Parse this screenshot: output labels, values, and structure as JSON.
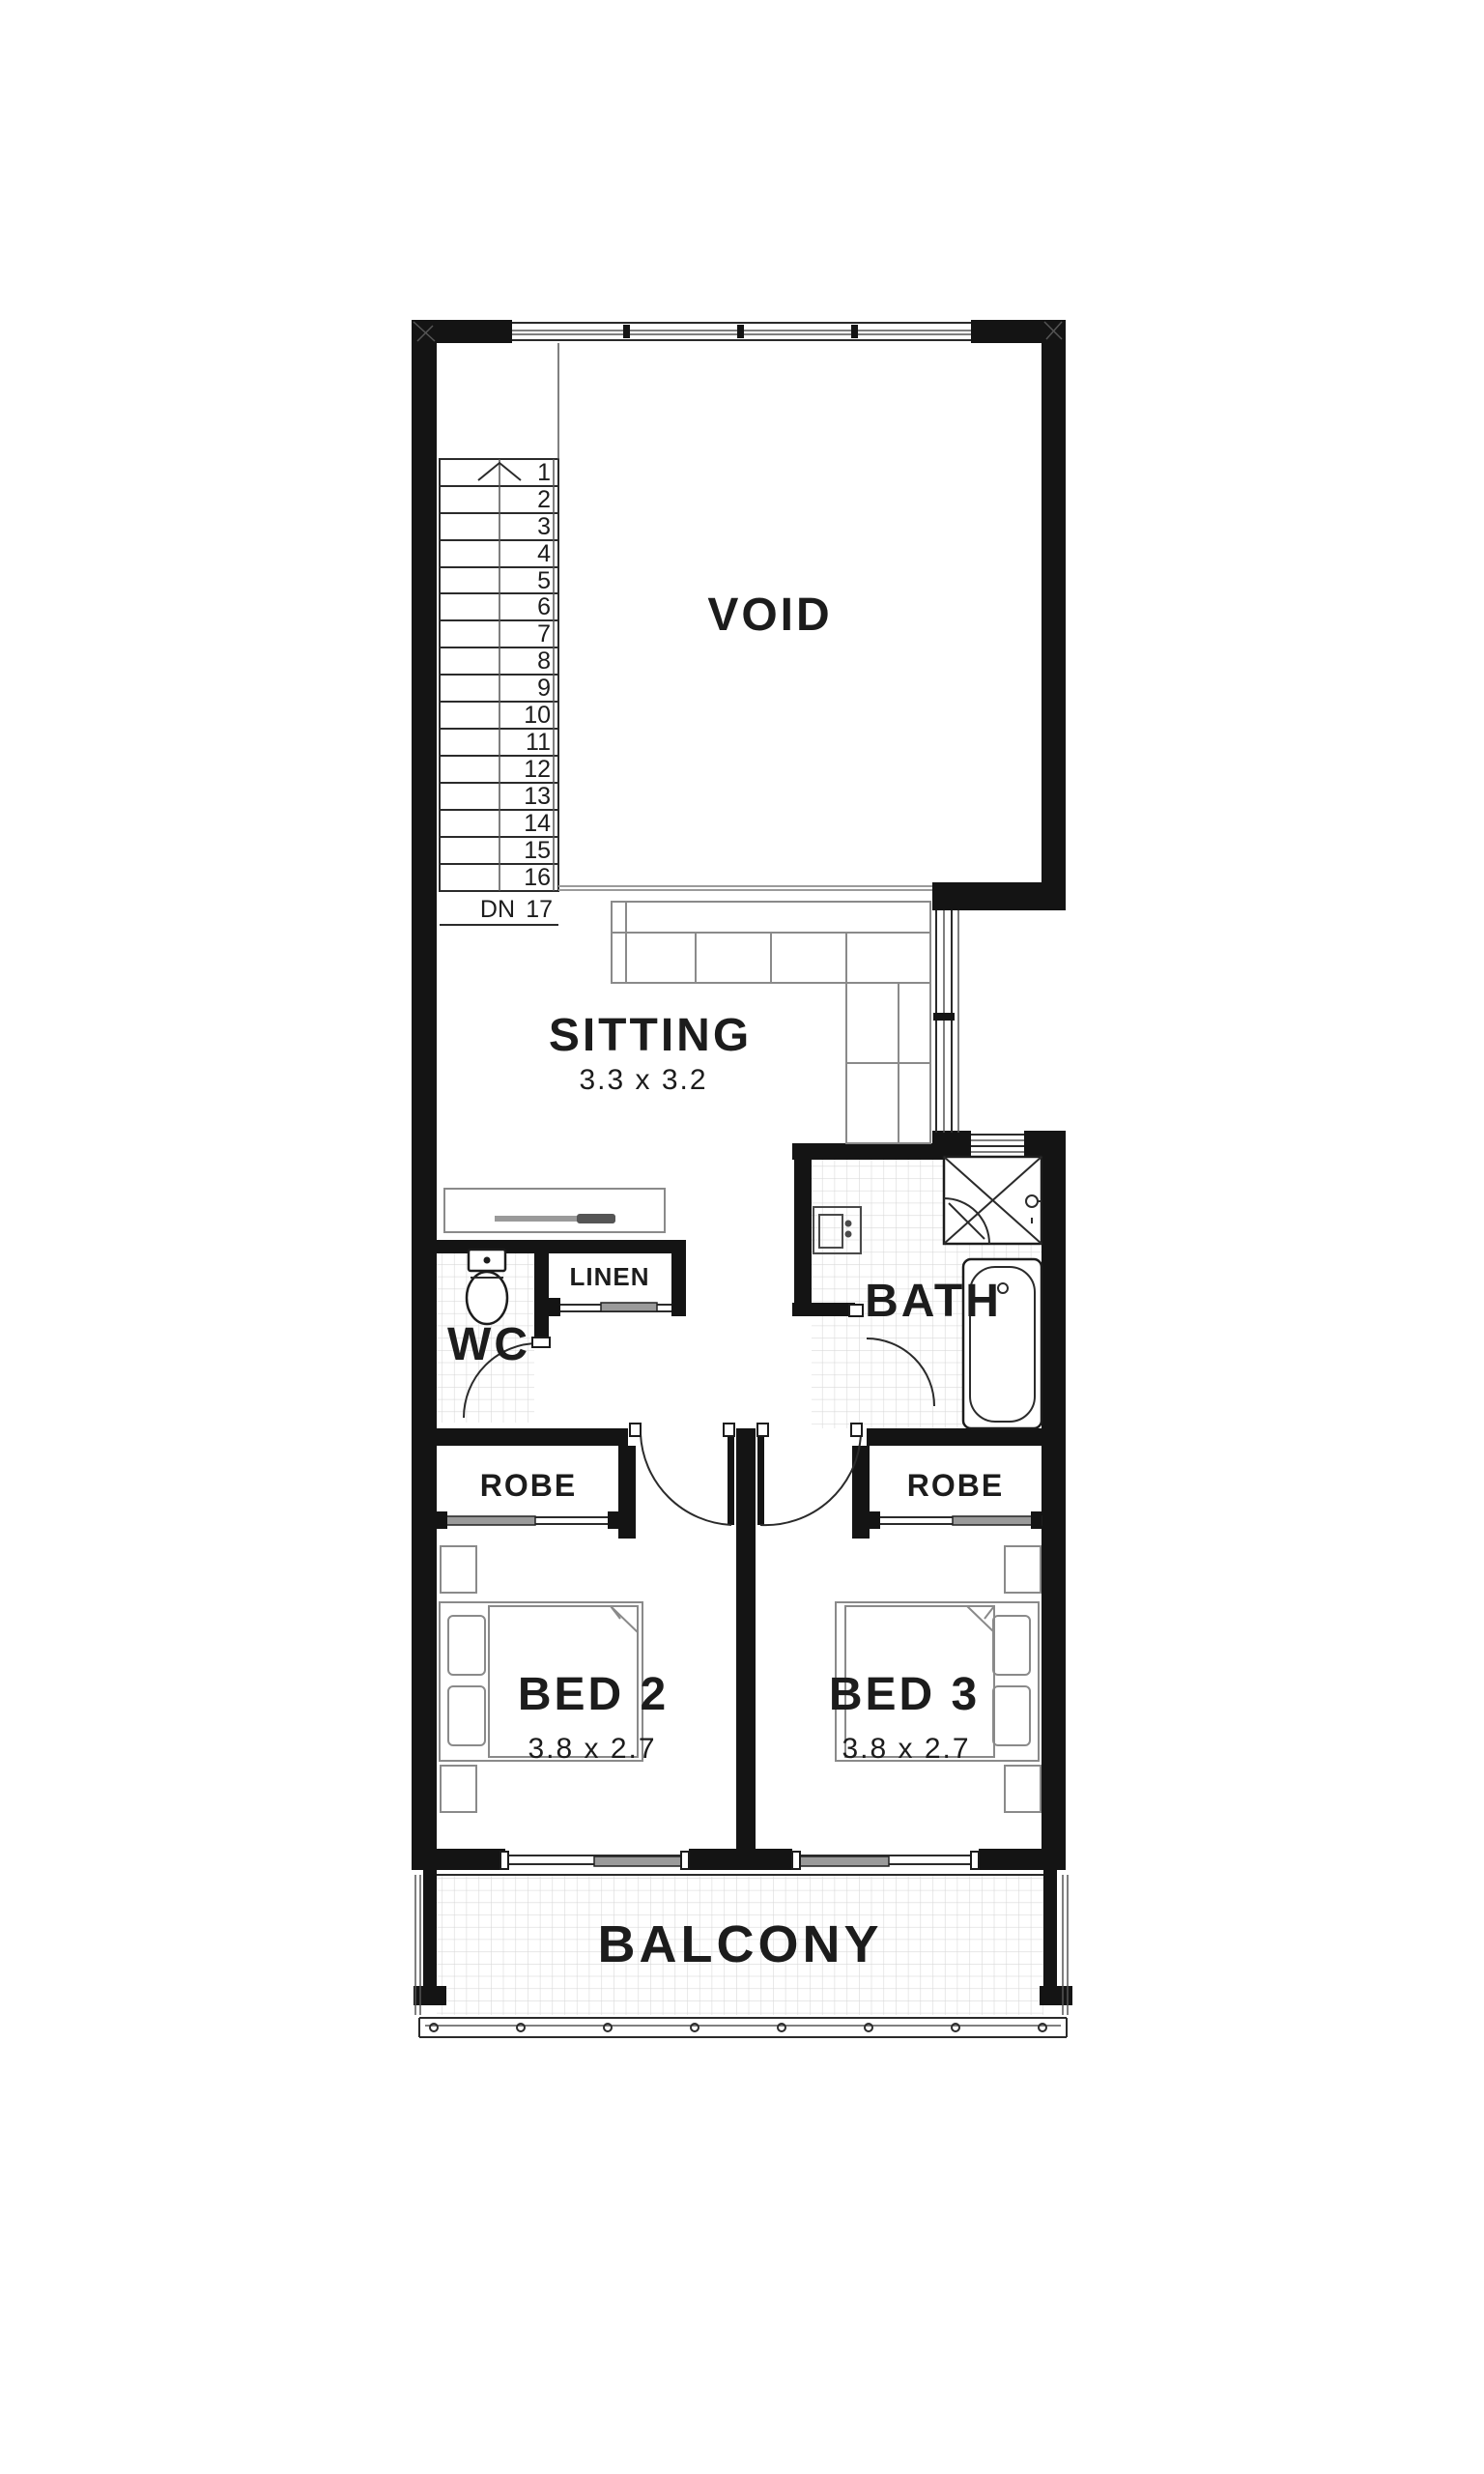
{
  "rooms": {
    "void": {
      "label": "VOID"
    },
    "sitting": {
      "label": "SITTING",
      "dim": "3.3 x 3.2"
    },
    "wc": {
      "label": "WC"
    },
    "linen": {
      "label": "LINEN"
    },
    "bath": {
      "label": "BATH"
    },
    "robe_left": {
      "label": "ROBE"
    },
    "robe_right": {
      "label": "ROBE"
    },
    "bed2": {
      "label": "BED 2",
      "dim": "3.8 x 2.7"
    },
    "bed3": {
      "label": "BED 3",
      "dim": "3.8 x 2.7"
    },
    "balcony": {
      "label": "BALCONY"
    }
  },
  "stairs": {
    "down_label": "DN",
    "numbers": [
      "1",
      "2",
      "3",
      "4",
      "5",
      "6",
      "7",
      "8",
      "9",
      "10",
      "11",
      "12",
      "13",
      "14",
      "15",
      "16"
    ],
    "bottom_step": "17"
  },
  "colors": {
    "wall": "#141414",
    "line": "#2b2b2b",
    "furniture": "#8a8a8a",
    "tile": "#d9d9d9",
    "text": "#1c1c1c"
  }
}
